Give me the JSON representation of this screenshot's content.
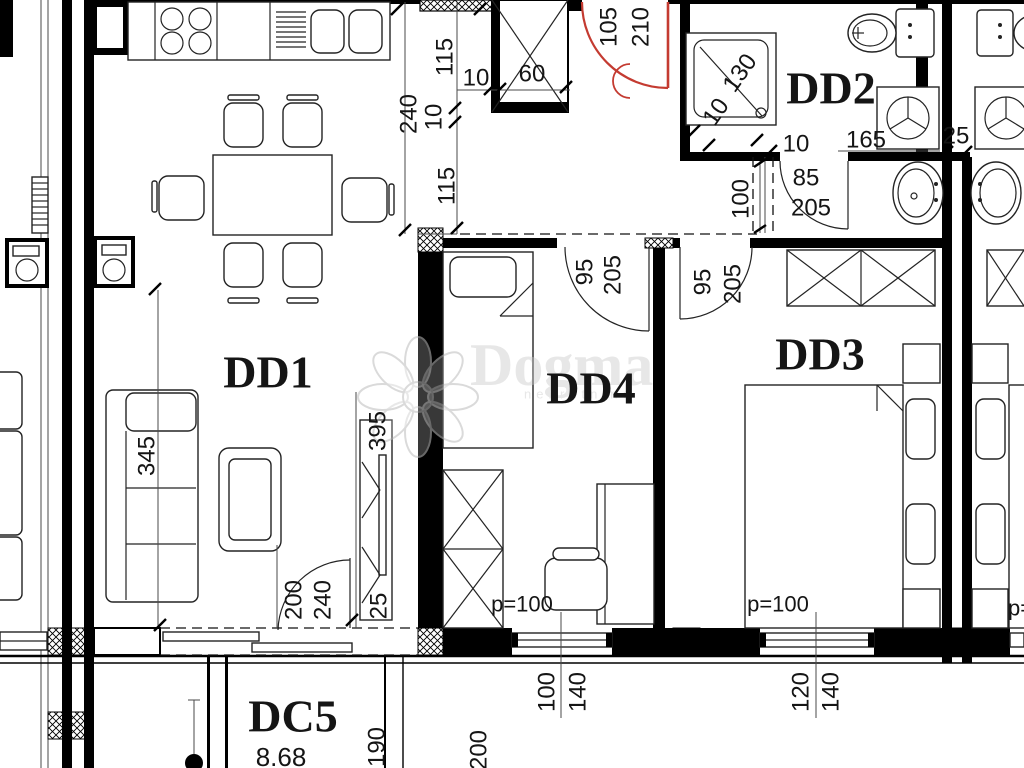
{
  "labels": {
    "room_dd1": "DD1",
    "room_dd2": "DD2",
    "room_dd3": "DD3",
    "room_dd4": "DD4",
    "room_dc5": "DC5",
    "area_dc5": "8.68",
    "dim_240_kitchen": "240",
    "dim_115_a": "115",
    "dim_10_shaft_wall": "10",
    "dim_60_shaft": "60",
    "dim_10_b": "10",
    "dim_115_b": "115",
    "door_entry_w": "105",
    "door_entry_h": "210",
    "dim_130_shower": "130",
    "dim_10_shower": "10",
    "dim_10_bath": "10",
    "dim_165_bath": "165",
    "dim_25_bath": "25",
    "door_dd2_w": "85",
    "door_dd2_h": "205",
    "dim_100_hall": "100",
    "door_dd4_w": "95",
    "door_dd4_h": "205",
    "door_dd3_w": "95",
    "door_dd3_h": "205",
    "dim_345_sofa": "345",
    "dim_395_board": "395",
    "dim_25_board": "25",
    "door_terr_w": "200",
    "door_terr_h": "240",
    "p_dd4": "p=100",
    "p_dd3": "p=100",
    "p_neighbor": "p=100",
    "win_dd4_w": "100",
    "win_dd4_h": "140",
    "win_dd3_w": "120",
    "win_dd3_h": "140",
    "dim_190_terr": "190",
    "dim_200_terr": "200",
    "wm_brand": "Dogma",
    "wm_tagline": "nekretnine"
  },
  "colors": {
    "entry_door": "#c43b31",
    "lines": "#000000",
    "watermark": "#c9c9c9"
  }
}
